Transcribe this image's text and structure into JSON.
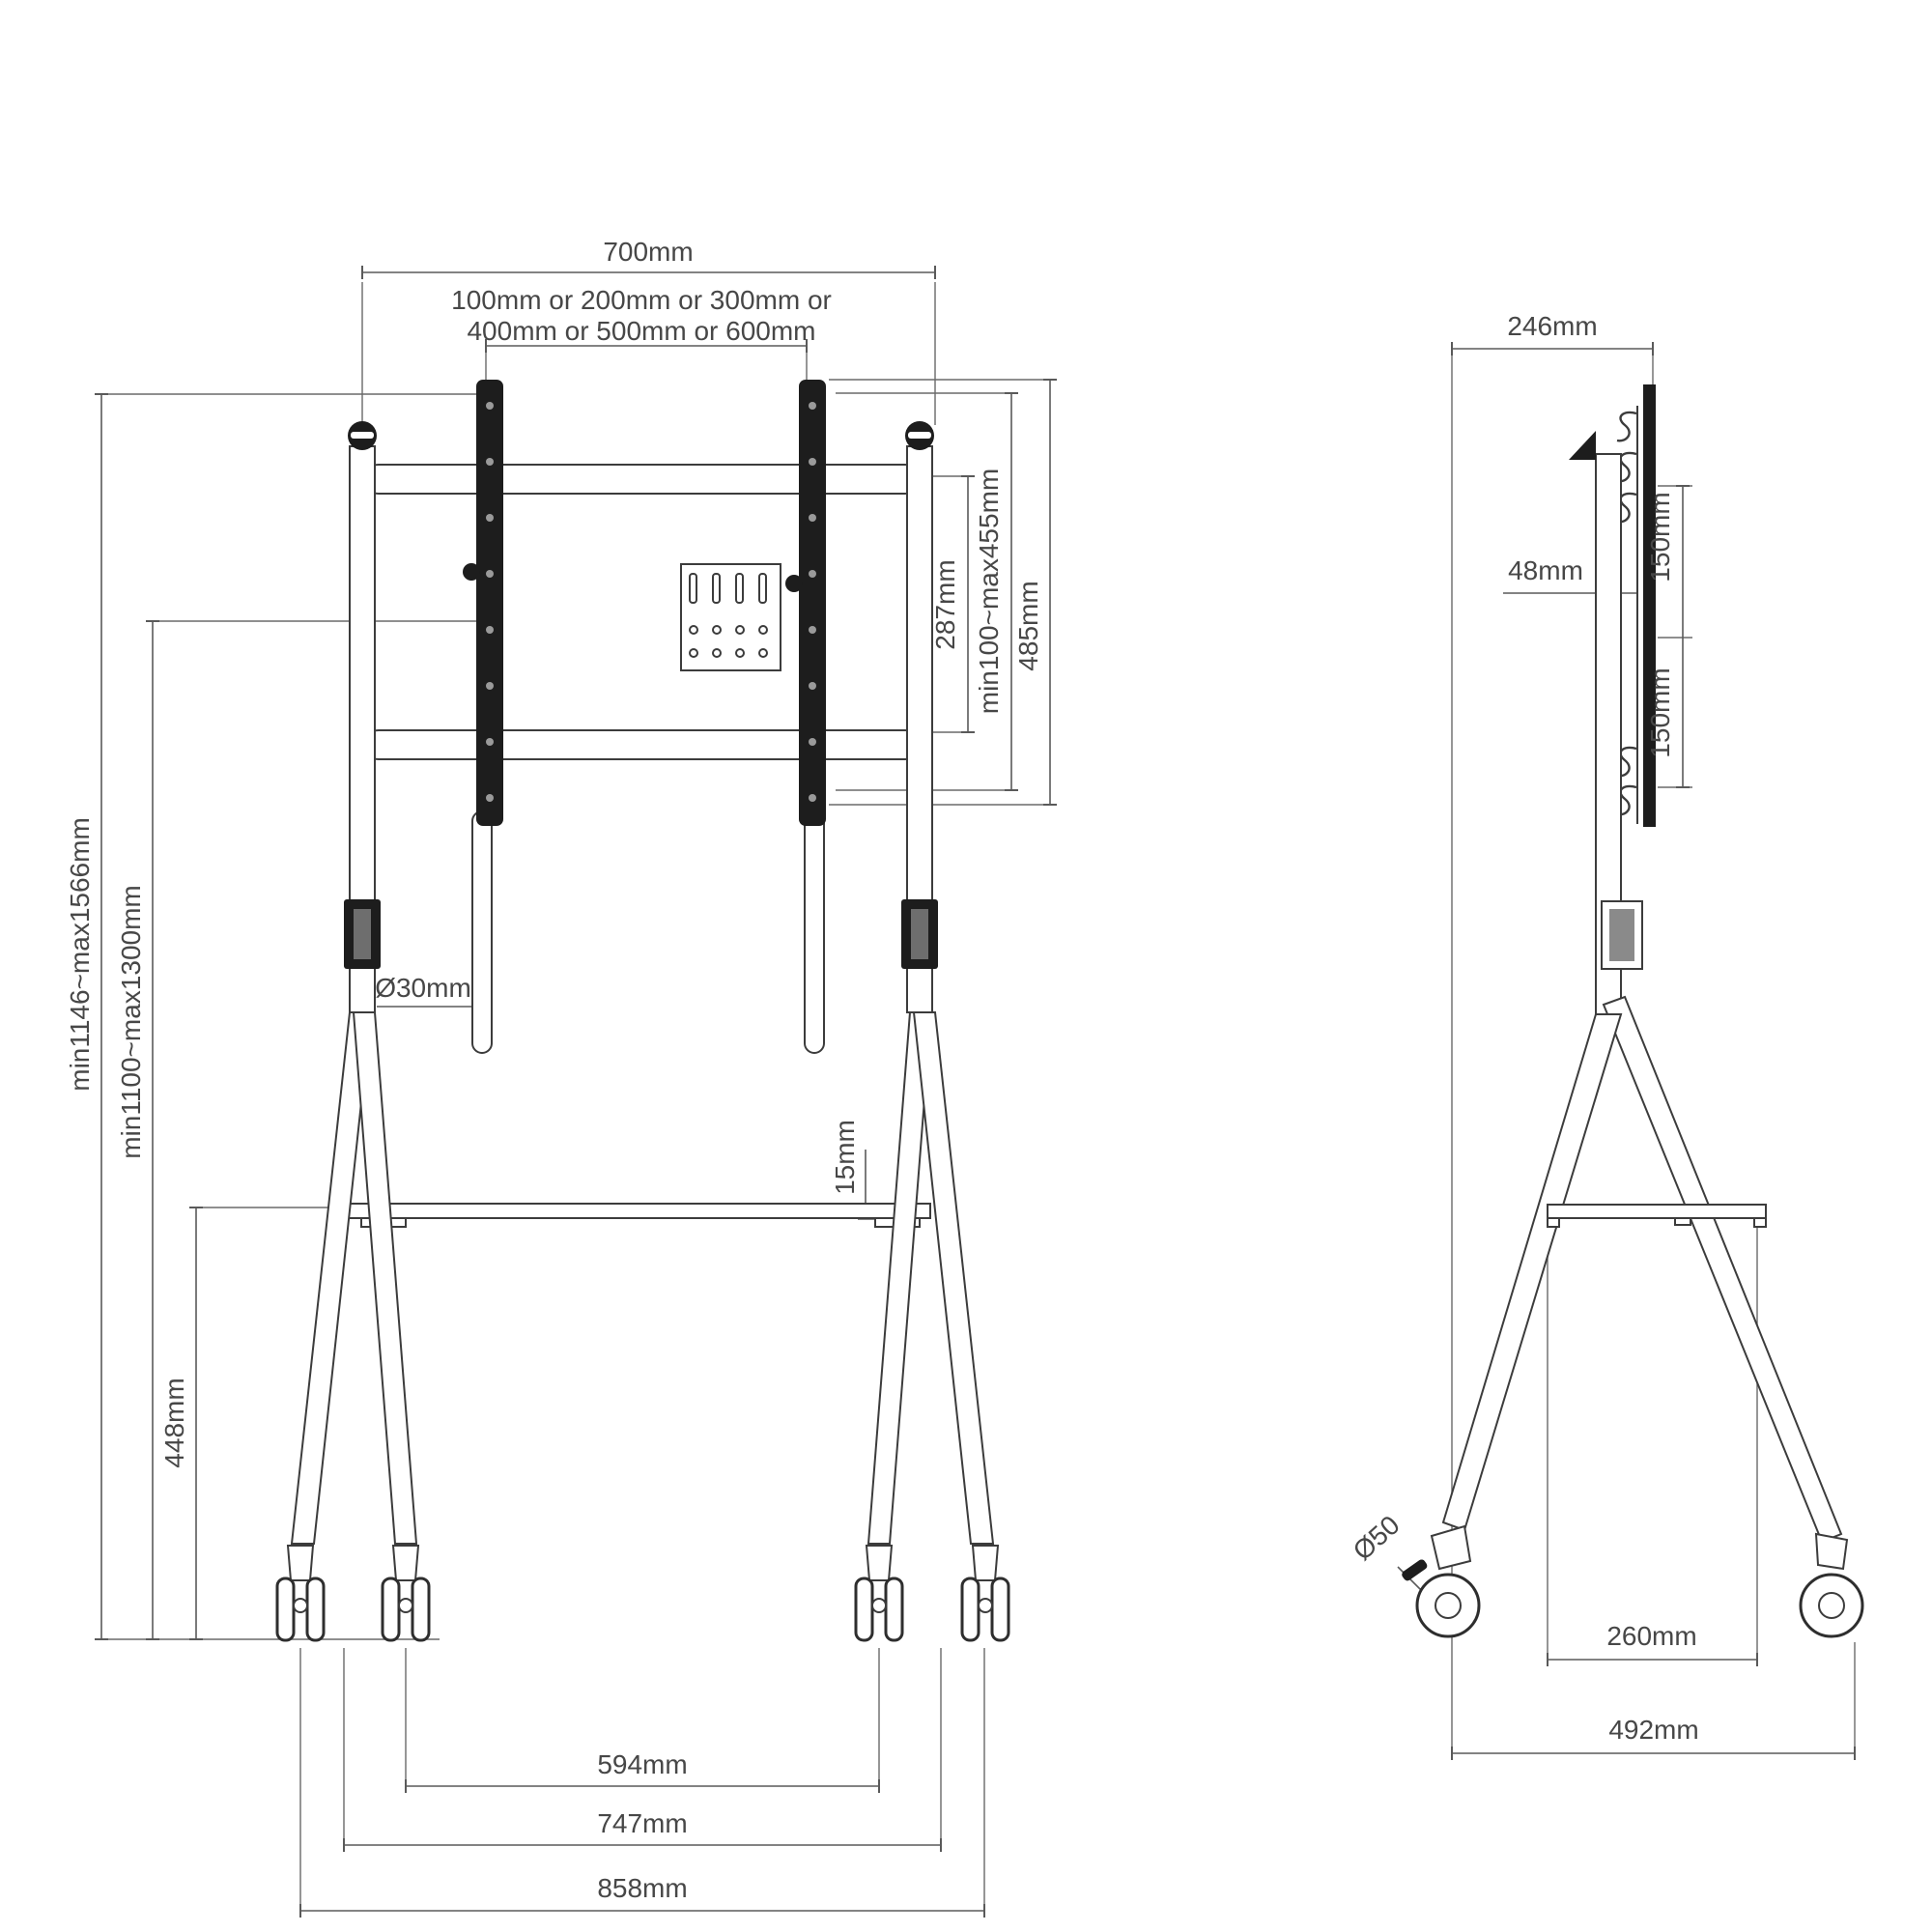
{
  "diagram": {
    "type": "technical-drawing",
    "subject": "mobile TV floor stand with casters, front and side orthographic views",
    "colors": {
      "background": "#ffffff",
      "line": "#3c3c3c",
      "dim_line": "#5a5a5a",
      "label": "#474747",
      "dark_fill": "#1d1d1d"
    },
    "front": {
      "dim_700": "700mm",
      "vesa_line1": "100mm or 200mm or 300mm or",
      "vesa_line2": "400mm or 500mm or 600mm",
      "dim_287": "287mm",
      "dim_100_455": "min100~max455mm",
      "dim_485": "485mm",
      "dim_1146_1566": "min1146~max1566mm",
      "dim_1100_1300": "min1100~max1300mm",
      "dim_30": "Ø30mm",
      "dim_15": "15mm",
      "dim_448": "448mm",
      "dim_594": "594mm",
      "dim_747": "747mm",
      "dim_858": "858mm"
    },
    "side": {
      "dim_246": "246mm",
      "dim_48": "48mm",
      "dim_150_upper": "150mm",
      "dim_150_lower": "150mm",
      "dim_50": "Ø50",
      "dim_260": "260mm",
      "dim_492": "492mm"
    }
  }
}
